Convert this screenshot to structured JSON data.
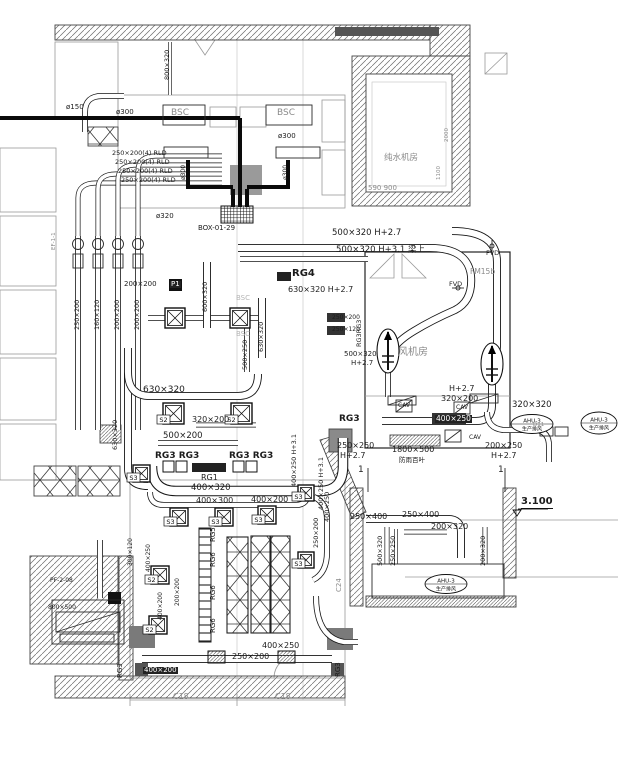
{
  "colors": {
    "line": "#1a1a1a",
    "gray": "#8a8a8a",
    "dark_fill": "#333333",
    "wall_fill": "#777777",
    "white": "#ffffff"
  },
  "labels": [
    {
      "t": "ø150",
      "x": 66,
      "y": 104,
      "fs": 7,
      "n": "pipe-size-label"
    },
    {
      "t": "800×320",
      "x": 164,
      "y": 80,
      "fs": 6.5,
      "rot": 1,
      "n": "duct-size-label"
    },
    {
      "t": "BSC",
      "x": 171,
      "y": 109,
      "fs": 9,
      "cls": "g",
      "n": "bsc-cabinet-label"
    },
    {
      "t": "BSC",
      "x": 277,
      "y": 109,
      "fs": 9,
      "cls": "g",
      "n": "bsc-cabinet-label"
    },
    {
      "t": "ø300",
      "x": 116,
      "y": 109,
      "fs": 7,
      "n": "pipe-size-label"
    },
    {
      "t": "ø300",
      "x": 278,
      "y": 133,
      "fs": 7,
      "n": "pipe-size-label"
    },
    {
      "t": "ø300",
      "x": 181,
      "y": 180,
      "fs": 6,
      "rot": 1,
      "n": "pipe-size-label"
    },
    {
      "t": "ø300",
      "x": 283,
      "y": 180,
      "fs": 6,
      "rot": 1,
      "n": "pipe-size-label"
    },
    {
      "t": "250×200(4) RLD",
      "x": 112,
      "y": 150,
      "fs": 6.5,
      "n": "duct-size-label"
    },
    {
      "t": "250×200(4) RLD",
      "x": 115,
      "y": 159,
      "fs": 6.5,
      "n": "duct-size-label"
    },
    {
      "t": "250×200(4) RLD",
      "x": 118,
      "y": 168,
      "fs": 6.5,
      "n": "duct-size-label"
    },
    {
      "t": "250×200(4) RLD",
      "x": 121,
      "y": 177,
      "fs": 6.5,
      "n": "duct-size-label"
    },
    {
      "t": "ø320",
      "x": 156,
      "y": 213,
      "fs": 7,
      "n": "pipe-size-label"
    },
    {
      "t": "BOX-01-29",
      "x": 198,
      "y": 225,
      "fs": 7,
      "n": "box-tag"
    },
    {
      "t": "纯水机房",
      "x": 384,
      "y": 154,
      "fs": 8.5,
      "cls": "g",
      "n": "room-label-pure-water"
    },
    {
      "t": "590 900",
      "x": 368,
      "y": 185,
      "fs": 7,
      "cls": "g",
      "n": "dimension-label"
    },
    {
      "t": "2000",
      "x": 445,
      "y": 142,
      "fs": 5.5,
      "rot": 1,
      "cls": "g",
      "n": "dimension-label"
    },
    {
      "t": "1100",
      "x": 437,
      "y": 180,
      "fs": 5.5,
      "rot": 1,
      "cls": "g",
      "n": "dimension-label"
    },
    {
      "t": "500×320 H+2.7",
      "x": 332,
      "y": 229,
      "fs": 8.5,
      "n": "duct-size-label"
    },
    {
      "t": "500×320 H+3.1 梁上",
      "x": 336,
      "y": 246,
      "fs": 8.5,
      "n": "duct-size-label"
    },
    {
      "t": "RG4",
      "x": 292,
      "y": 269,
      "fs": 10,
      "cls": "b",
      "n": "grille-tag"
    },
    {
      "t": "630×320 H+2.7",
      "x": 288,
      "y": 286,
      "fs": 8,
      "n": "duct-size-label"
    },
    {
      "t": "FVD",
      "x": 486,
      "y": 250,
      "fs": 6.5,
      "n": "damper-tag"
    },
    {
      "t": "FVD",
      "x": 449,
      "y": 281,
      "fs": 6.5,
      "n": "damper-tag"
    },
    {
      "t": "FM15b",
      "x": 470,
      "y": 268,
      "fs": 7.5,
      "cls": "g",
      "n": "door-tag"
    },
    {
      "t": "风机房",
      "x": 398,
      "y": 348,
      "fs": 10,
      "cls": "g",
      "n": "room-label-fan-room"
    },
    {
      "t": "EF-1-1",
      "x": 52,
      "y": 250,
      "fs": 5.5,
      "rot": 1,
      "cls": "g",
      "n": "fan-tag"
    },
    {
      "t": "250×200",
      "x": 74,
      "y": 330,
      "fs": 6.5,
      "rot": 1,
      "n": "duct-size-label"
    },
    {
      "t": "160×120",
      "x": 94,
      "y": 330,
      "fs": 6.5,
      "rot": 1,
      "n": "duct-size-label"
    },
    {
      "t": "200×200",
      "x": 114,
      "y": 330,
      "fs": 6.5,
      "rot": 1,
      "n": "duct-size-label"
    },
    {
      "t": "200×200",
      "x": 134,
      "y": 330,
      "fs": 6.5,
      "rot": 1,
      "n": "duct-size-label"
    },
    {
      "t": "200×200",
      "x": 124,
      "y": 281,
      "fs": 7,
      "n": "duct-size-label"
    },
    {
      "t": "P1",
      "x": 170,
      "y": 281,
      "fs": 7,
      "cls": "w",
      "n": "fan-box-tag"
    },
    {
      "t": "600×320",
      "x": 202,
      "y": 312,
      "fs": 6.5,
      "rot": 1,
      "n": "duct-size-label"
    },
    {
      "t": "630×320",
      "x": 258,
      "y": 352,
      "fs": 6.5,
      "rot": 1,
      "n": "duct-size-label"
    },
    {
      "t": "500×250",
      "x": 242,
      "y": 370,
      "fs": 6.5,
      "rot": 1,
      "n": "duct-size-label"
    },
    {
      "t": "250×200",
      "x": 332,
      "y": 315,
      "fs": 6,
      "n": "duct-size-label"
    },
    {
      "t": "250×120",
      "x": 332,
      "y": 327,
      "fs": 6,
      "n": "duct-size-label"
    },
    {
      "t": "RG3RG3",
      "x": 356,
      "y": 347,
      "fs": 6.5,
      "rot": 1,
      "n": "grille-tag"
    },
    {
      "t": "500×320",
      "x": 344,
      "y": 351,
      "fs": 7,
      "n": "duct-size-label"
    },
    {
      "t": "H+2.7",
      "x": 351,
      "y": 360,
      "fs": 7,
      "n": "height-label"
    },
    {
      "t": "BSC",
      "x": 236,
      "y": 295,
      "fs": 7,
      "cls": "g2",
      "n": "bsc-cabinet-label"
    },
    {
      "t": "BSC",
      "x": 236,
      "y": 331,
      "fs": 7,
      "cls": "g2",
      "n": "bsc-cabinet-label"
    },
    {
      "t": "630×320",
      "x": 143,
      "y": 386,
      "fs": 9,
      "n": "duct-size-label"
    },
    {
      "t": "320×200",
      "x": 192,
      "y": 416,
      "fs": 8,
      "n": "duct-size-label"
    },
    {
      "t": "500×200",
      "x": 163,
      "y": 432,
      "fs": 8.5,
      "n": "duct-size-label"
    },
    {
      "t": "RG3 RG3",
      "x": 155,
      "y": 452,
      "fs": 9,
      "cls": "b",
      "n": "grille-tag"
    },
    {
      "t": "RG3 RG3",
      "x": 229,
      "y": 452,
      "fs": 9,
      "cls": "b",
      "n": "grille-tag"
    },
    {
      "t": "RG1",
      "x": 201,
      "y": 474,
      "fs": 8,
      "n": "grille-tag"
    },
    {
      "t": "400×320",
      "x": 191,
      "y": 484,
      "fs": 8.5,
      "n": "duct-size-label"
    },
    {
      "t": "400×300",
      "x": 196,
      "y": 497,
      "fs": 8,
      "n": "duct-size-label"
    },
    {
      "t": "400×200",
      "x": 251,
      "y": 496,
      "fs": 8,
      "n": "duct-size-label"
    },
    {
      "t": "630×320",
      "x": 112,
      "y": 450,
      "fs": 6.5,
      "rot": 1,
      "n": "duct-size-label"
    },
    {
      "t": "RG5",
      "x": 210,
      "y": 542,
      "fs": 7,
      "rot": 1,
      "n": "grille-tag"
    },
    {
      "t": "RG6",
      "x": 210,
      "y": 567,
      "fs": 7,
      "rot": 1,
      "n": "grille-tag"
    },
    {
      "t": "RG6",
      "x": 210,
      "y": 600,
      "fs": 7,
      "rot": 1,
      "n": "grille-tag"
    },
    {
      "t": "RG6",
      "x": 210,
      "y": 633,
      "fs": 7,
      "rot": 1,
      "n": "grille-tag"
    },
    {
      "t": "400×250",
      "x": 324,
      "y": 522,
      "fs": 6.5,
      "rot": 1,
      "n": "duct-size-label"
    },
    {
      "t": "250×200",
      "x": 313,
      "y": 548,
      "fs": 6.5,
      "rot": 1,
      "n": "duct-size-label"
    },
    {
      "t": "C24",
      "x": 336,
      "y": 592,
      "fs": 7,
      "rot": 1,
      "cls": "g",
      "n": "column-grid-label"
    },
    {
      "t": "400×250",
      "x": 262,
      "y": 642,
      "fs": 8,
      "n": "duct-size-label"
    },
    {
      "t": "250×200",
      "x": 232,
      "y": 653,
      "fs": 8,
      "n": "duct-size-label"
    },
    {
      "t": "400×200",
      "x": 143,
      "y": 667,
      "fs": 7,
      "cls": "w",
      "n": "duct-size-label"
    },
    {
      "t": "C18",
      "x": 173,
      "y": 693,
      "fs": 8,
      "cls": "g",
      "n": "column-grid-label"
    },
    {
      "t": "C18",
      "x": 275,
      "y": 693,
      "fs": 8,
      "cls": "g",
      "n": "column-grid-label"
    },
    {
      "t": "RG3",
      "x": 117,
      "y": 678,
      "fs": 7,
      "rot": 1,
      "n": "grille-tag"
    },
    {
      "t": "RG3",
      "x": 335,
      "y": 677,
      "fs": 7,
      "rot": 1,
      "n": "grille-tag"
    },
    {
      "t": "PF-2-08",
      "x": 50,
      "y": 578,
      "fs": 6,
      "n": "fan-tag"
    },
    {
      "t": "800×500",
      "x": 48,
      "y": 605,
      "fs": 6,
      "n": "louver-size-label"
    },
    {
      "t": "300×120",
      "x": 128,
      "y": 566,
      "fs": 6,
      "rot": 1,
      "n": "duct-size-label"
    },
    {
      "t": "400×250",
      "x": 146,
      "y": 572,
      "fs": 6,
      "rot": 1,
      "n": "duct-size-label"
    },
    {
      "t": "400×200",
      "x": 158,
      "y": 620,
      "fs": 6,
      "rot": 1,
      "n": "duct-size-label"
    },
    {
      "t": "200×200",
      "x": 175,
      "y": 606,
      "fs": 6,
      "rot": 1,
      "n": "duct-size-label"
    },
    {
      "t": "400×250 H+3.1",
      "x": 291,
      "y": 487,
      "fs": 6.5,
      "rot": 1,
      "n": "duct-size-label"
    },
    {
      "t": "400×250 H+3.1",
      "x": 318,
      "y": 510,
      "fs": 6.5,
      "rot": 1,
      "n": "duct-size-label"
    },
    {
      "t": "H+2.7",
      "x": 449,
      "y": 385,
      "fs": 8,
      "n": "height-label"
    },
    {
      "t": "320×200",
      "x": 441,
      "y": 395,
      "fs": 8,
      "n": "duct-size-label"
    },
    {
      "t": "CAV",
      "x": 398,
      "y": 403,
      "fs": 6,
      "n": "cav-box-tag"
    },
    {
      "t": "CAV",
      "x": 456,
      "y": 405,
      "fs": 6,
      "n": "cav-box-tag"
    },
    {
      "t": "CAV",
      "x": 469,
      "y": 435,
      "fs": 6,
      "n": "cav-box-tag"
    },
    {
      "t": "400×250",
      "x": 435,
      "y": 415,
      "fs": 7.5,
      "cls": "w",
      "n": "duct-size-label"
    },
    {
      "t": "320×320",
      "x": 512,
      "y": 401,
      "fs": 8.5,
      "n": "duct-size-label"
    },
    {
      "t": "D11",
      "x": 533,
      "y": 423,
      "fs": 5.5,
      "cls": "g",
      "n": "device-tag"
    },
    {
      "t": "250×250",
      "x": 337,
      "y": 442,
      "fs": 8,
      "n": "duct-size-label"
    },
    {
      "t": "H+2.7",
      "x": 340,
      "y": 452,
      "fs": 8,
      "n": "height-label"
    },
    {
      "t": "1800×500",
      "x": 392,
      "y": 446,
      "fs": 8,
      "n": "louver-size-label"
    },
    {
      "t": "防雨百叶",
      "x": 399,
      "y": 457,
      "fs": 6.5,
      "n": "louver-name-label"
    },
    {
      "t": "200×250",
      "x": 485,
      "y": 442,
      "fs": 8,
      "n": "duct-size-label"
    },
    {
      "t": "H+2.7",
      "x": 491,
      "y": 452,
      "fs": 8,
      "n": "height-label"
    },
    {
      "t": "RG3",
      "x": 339,
      "y": 415,
      "fs": 9,
      "cls": "b",
      "n": "grille-tag"
    },
    {
      "t": "3.100",
      "x": 521,
      "y": 497,
      "fs": 10,
      "cls": "lvl",
      "n": "level-mark-label"
    },
    {
      "t": "250×400",
      "x": 350,
      "y": 513,
      "fs": 8,
      "n": "duct-size-label"
    },
    {
      "t": "250×400",
      "x": 402,
      "y": 511,
      "fs": 8,
      "n": "duct-size-label"
    },
    {
      "t": "200×320",
      "x": 431,
      "y": 523,
      "fs": 8,
      "n": "duct-size-label"
    },
    {
      "t": "500×320",
      "x": 377,
      "y": 566,
      "fs": 6.5,
      "rot": 1,
      "n": "duct-size-label"
    },
    {
      "t": "250×250",
      "x": 390,
      "y": 566,
      "fs": 6.5,
      "rot": 1,
      "n": "duct-size-label"
    },
    {
      "t": "200×320",
      "x": 480,
      "y": 566,
      "fs": 6.5,
      "rot": 1,
      "n": "duct-size-label"
    },
    {
      "t": "1",
      "x": 358,
      "y": 466,
      "fs": 9,
      "n": "section-cut-number"
    },
    {
      "t": "1",
      "x": 498,
      "y": 466,
      "fs": 9,
      "n": "section-cut-number"
    }
  ],
  "diffusers": [
    {
      "x": 165,
      "y": 308,
      "s": 20,
      "tag": ""
    },
    {
      "x": 230,
      "y": 308,
      "s": 20,
      "tag": ""
    },
    {
      "x": 163,
      "y": 403,
      "s": 21,
      "tag": "S2"
    },
    {
      "x": 231,
      "y": 403,
      "s": 21,
      "tag": "S2"
    },
    {
      "x": 133,
      "y": 465,
      "s": 17,
      "tag": "S3"
    },
    {
      "x": 170,
      "y": 508,
      "s": 18,
      "tag": "S3"
    },
    {
      "x": 215,
      "y": 508,
      "s": 18,
      "tag": "S3"
    },
    {
      "x": 258,
      "y": 506,
      "s": 18,
      "tag": "S3"
    },
    {
      "x": 298,
      "y": 485,
      "s": 16,
      "tag": "S3"
    },
    {
      "x": 298,
      "y": 552,
      "s": 16,
      "tag": "S3"
    },
    {
      "x": 151,
      "y": 566,
      "s": 18,
      "tag": "S2"
    },
    {
      "x": 149,
      "y": 616,
      "s": 18,
      "tag": "S2"
    }
  ],
  "fan_tags": [
    {
      "cx": 532,
      "cy": 424,
      "rx": 21,
      "ry": 9.5,
      "line1": "AHU-3",
      "line2": "生产排风"
    },
    {
      "cx": 599,
      "cy": 423,
      "rx": 18,
      "ry": 11,
      "line1": "AHU-3",
      "line2": "生产排风"
    },
    {
      "cx": 446,
      "cy": 584,
      "rx": 21,
      "ry": 9.5,
      "line1": "AHU-3",
      "line2": "生产排风"
    }
  ]
}
